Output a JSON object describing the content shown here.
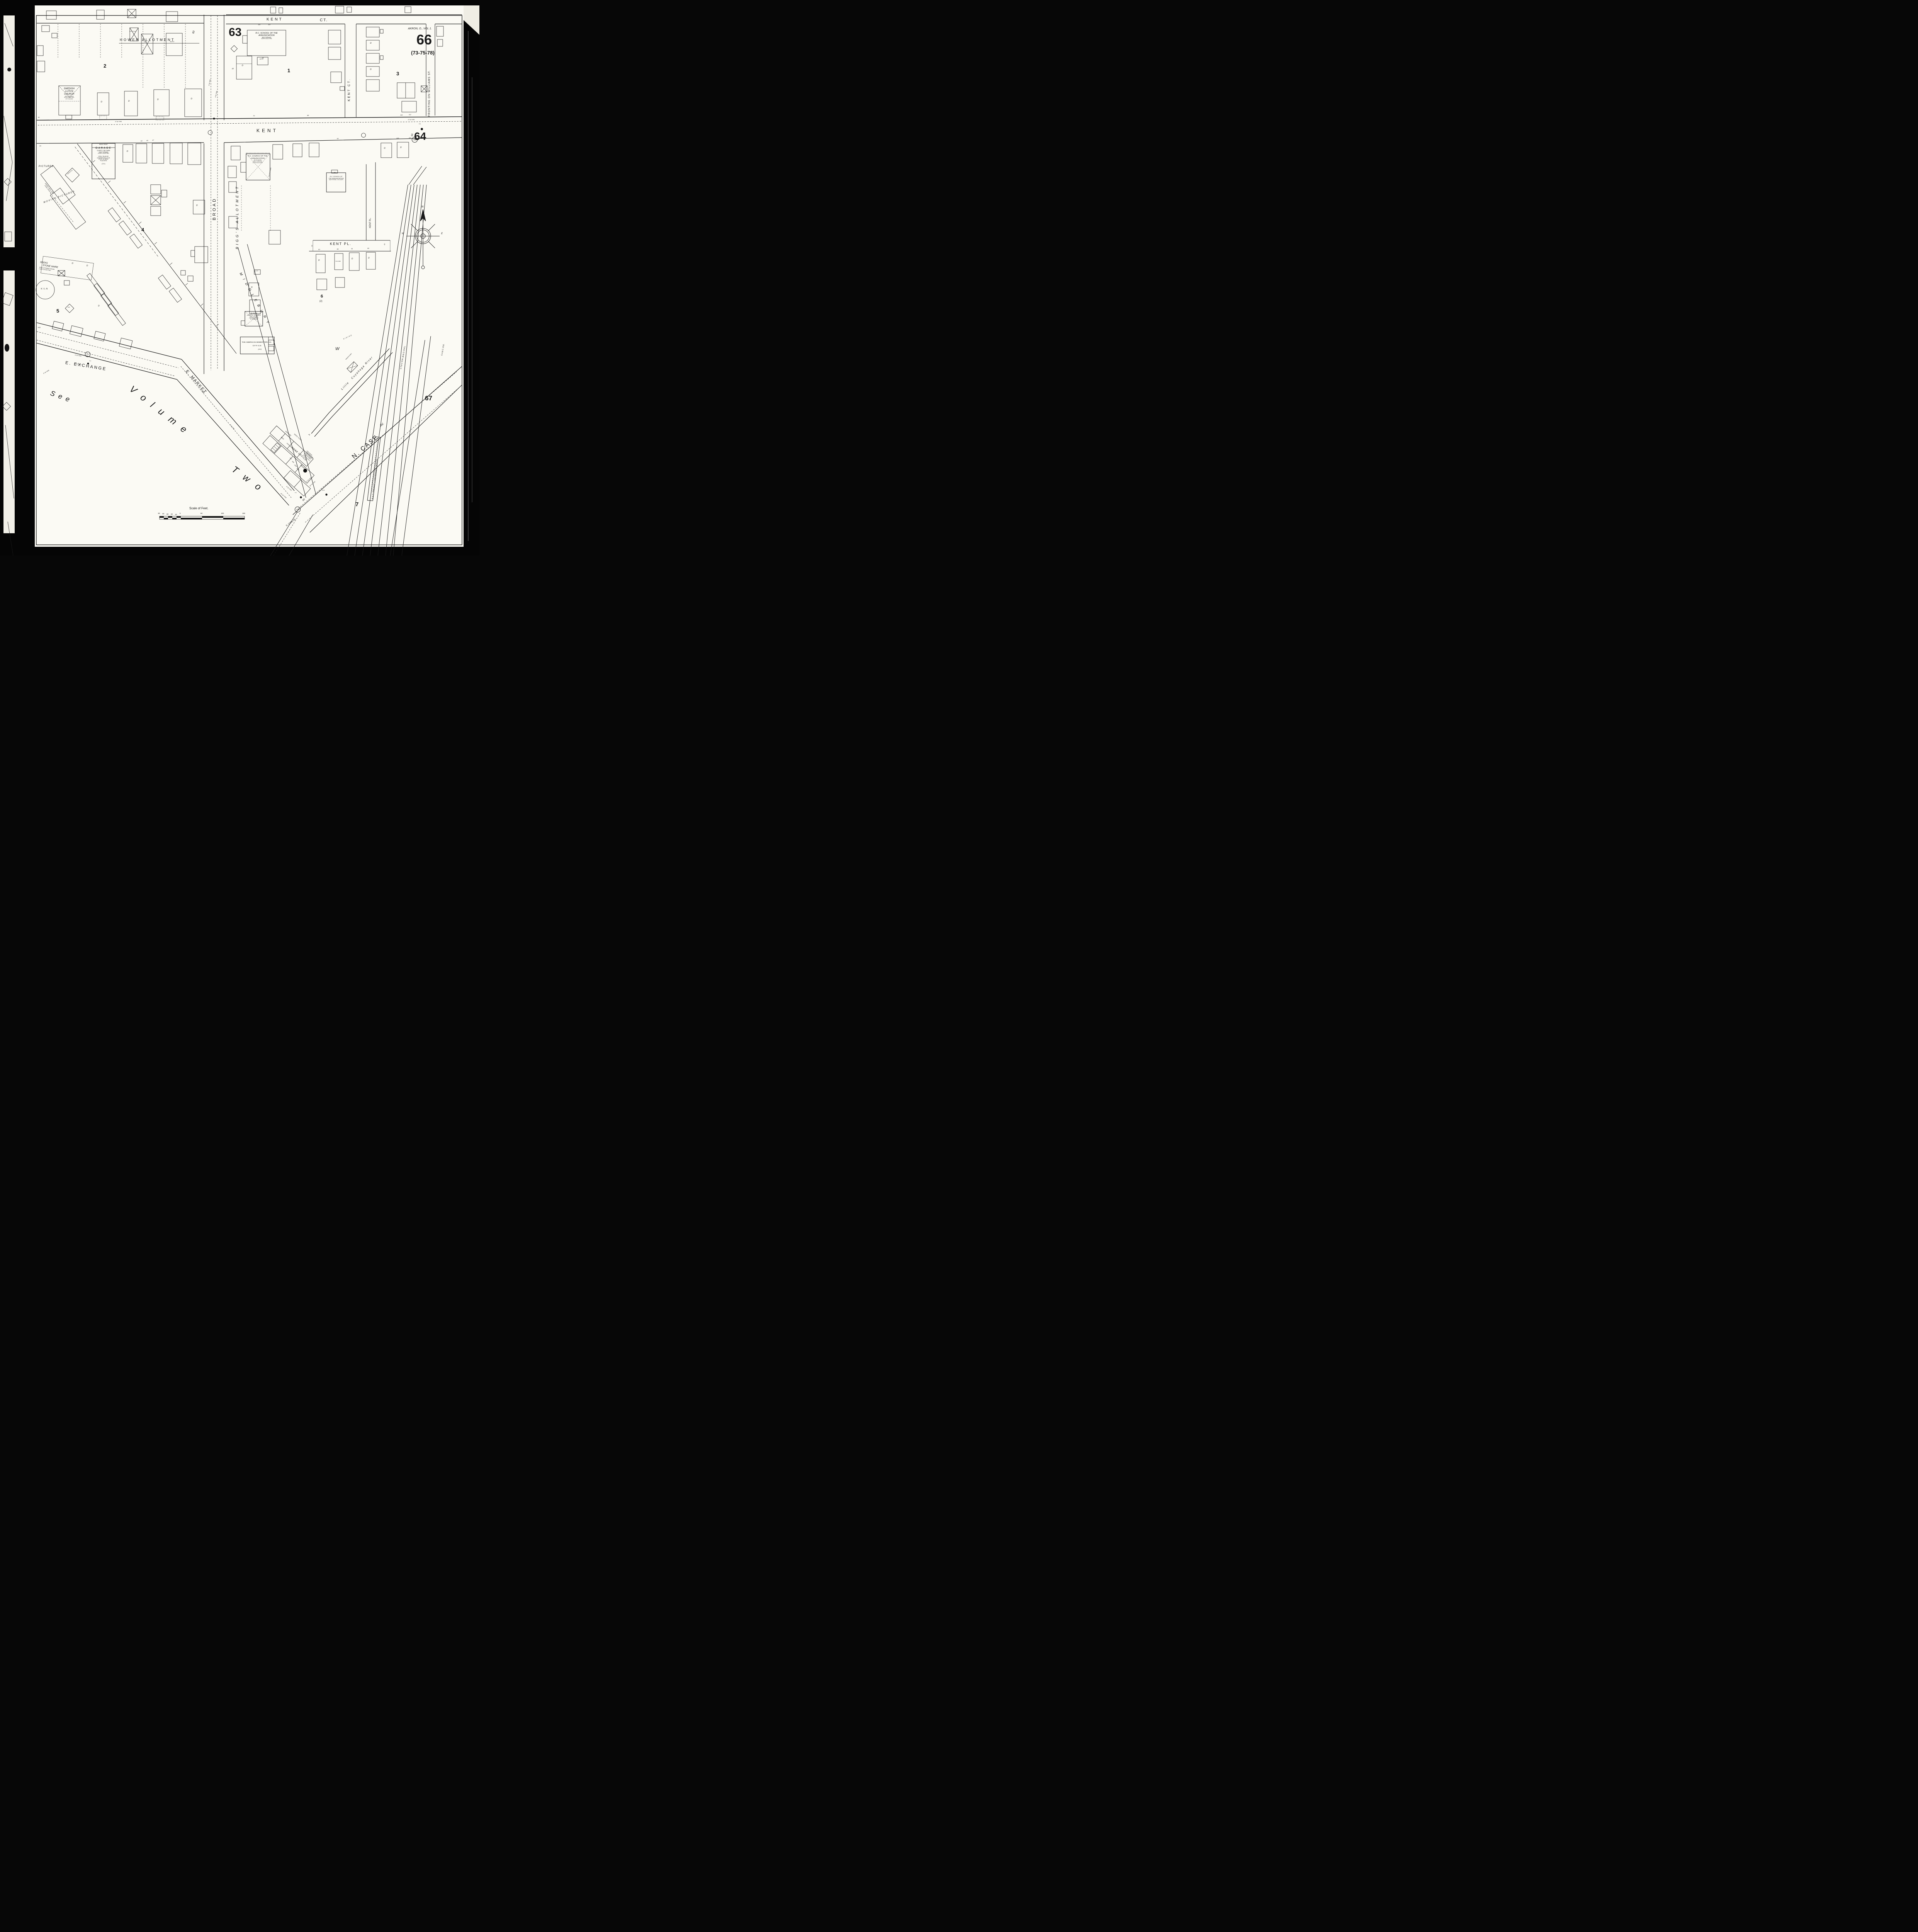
{
  "sheet_header": {
    "volume_label": "AKRON, O., VOL 1.",
    "sheet_number": "66",
    "cross_reference": "(73-75-78)"
  },
  "adjacent_sheets": {
    "top_left": "63",
    "right": "64",
    "bottom_right": "67"
  },
  "blocks": {
    "b1": "1",
    "b2": "2",
    "b3": "3",
    "b4": "4",
    "b5": "5",
    "b6": "6",
    "b6_sub": "(2)",
    "b7": "7",
    "hower": "HOWER ALLOTMENT",
    "biggs": "BIGG'S ALLOTMENT"
  },
  "streets": {
    "kent_ct_top_1": "KENT",
    "kent_ct_top_2": "CT.",
    "kent": "KENT",
    "kent_ct_vertical": "KENT CT.",
    "kent_pl": "KENT PL.",
    "kent_pl_vertical": "KENT PL.",
    "broad": "BROAD",
    "williams": "FRONTING ON WILLIAMS ST.",
    "e_exchange": "E. EXCHANGE",
    "e_market": "E. MARKET",
    "middlebury": "MIDDLEBURY",
    "middlebury_w": "W",
    "n_case": "N. CASE",
    "n_case_av": "AV.",
    "s_case": "S. CASE AV.",
    "see_volume_1": "See",
    "see_volume_2": "Volume",
    "see_volume_3": "Two",
    "width_60_broad": "60",
    "width_60_kent": "60",
    "width_60_market": "60",
    "width_60_case": "60"
  },
  "buildings": {
    "swedish_church": {
      "lines": [
        "SWEDISH",
        "LUTH'N",
        "CHURCH",
        "HEAT FURNACE",
        "LIGHTS ELECTRIC",
        "18' TO EAVES"
      ]
    },
    "rc_school_top": {
      "lines": [
        "R.C. SCHOOL OF THE",
        "ANNUNCIATION",
        "HEAT FURNACE",
        "LIGHTS ELECTRIC"
      ]
    },
    "annunciation_church": {
      "lines": [
        "R.C. CHURCH OF THE",
        "ANNUNCIATION",
        "28' TO EAVES",
        "HEAT FURNACE",
        "LIGHTS ELECTRIC"
      ],
      "side": "TILE PLASTERED"
    },
    "rc_school": {
      "lines": [
        "R.C. SCHOOL OF",
        "THE ANNUNCIATION",
        "HEAT STOVES - NO LIGHTS"
      ],
      "height": "25'"
    },
    "garage": {
      "lines": [
        "BRICK FRONT",
        "GARAGE",
        "CAPCY. 30 CARS",
        "HEAT: FURNACE",
        "LIGHTS: ELECTRIC",
        "STEEL TRUSS RF.",
        "CONCRETE RF. & FLR.",
        "8\"x16\"-16' BRICK",
        "PILASTERS",
        "(C.B.)"
      ]
    },
    "dance_hall": {
      "lines": [
        "DANCE HALL 2ND",
        "STEEL TRUSS RF."
      ]
    },
    "pictures": "PICTURES",
    "moving_pictures": "MOVING PICTURES",
    "auto_cb": "AUTO (C.B.)",
    "stone_ware": {
      "lines": [
        "SEEKS",
        "STONE WARE",
        "HEAT & POWER STEAM",
        "LIGHTS ELECTRIC"
      ]
    },
    "kiln": "KILN",
    "slavon_church": {
      "lines": [
        "SLAVON",
        "LUTH'N. CHURCH",
        "HEAT: FURNACE",
        "LIGHTS ELECTRIC",
        "16' TO EAVES"
      ]
    },
    "sewer_pipe_office": {
      "line1": "THE AMERICAN SEWER PIPE CO.",
      "line2": "OFFICE",
      "number": "(112)"
    },
    "post_office": "POST OFFICE",
    "drugs": "DRUGS",
    "fire_proof": {
      "lines": [
        "FIRE PROOF",
        "CONSTRUCTION",
        "STEEL FRAMED",
        "FLOORS CONC.",
        "CURTAIN WALLS"
      ]
    },
    "river_boarded": "RIVER BOARDED OVER",
    "seeds_flour": "SEEDS, FLOUR",
    "supplies": "SUPPLIES",
    "seed": "SEED",
    "wagon_shed": "WAGON SHED",
    "depot": "B.& O. FREIGHT & PASSENGER DEPOT",
    "auto_tile": "AUTO TILE",
    "tile": "TILE",
    "tile_lined": "TILE LINED",
    "auto": "AUTO",
    "dwelling": "D",
    "off": "OFF",
    "ho": "HO",
    "dh": "D.H."
  },
  "railroads": {
    "ctv": "C.T.& V. R.R. (B.& O. R.R.)",
    "cac": "C.A.& C. R.R.",
    "siding": "SIDING"
  },
  "river": {
    "word1": "Little",
    "word2": "Cuyahoga",
    "word3": "River"
  },
  "utilities": {
    "pipe_6": "6\" W. PIPE",
    "pipe_4": "4\" W. PIPE",
    "pipe_24": "24\" W. PIPE",
    "pipe_30": "30\" W. PIPE",
    "pipe_8": "8\" W. PIPE",
    "th": "T.H.",
    "manhole_188": "188",
    "manhole_227": "227",
    "manhole_205": "205"
  },
  "house_numbers": {
    "kent_north": [
      "30",
      "70",
      "88",
      "110",
      "112"
    ],
    "kent_south": [
      "25",
      "43",
      "45",
      "47",
      "93",
      "103",
      "107"
    ],
    "kent_pl": [
      "83",
      "85",
      "91",
      "95"
    ],
    "kent_pl_width": "25'",
    "market": [
      "997",
      "999",
      "1001",
      "1003"
    ],
    "block1_top": [
      "118",
      "119"
    ],
    "misc_26": "26",
    "misc_31": "31",
    "misc_32": "32"
  },
  "compass": {
    "n": "N",
    "e": "E",
    "w": "W"
  },
  "scale_bar": {
    "title": "Scale of Feet.",
    "ticks": [
      "50",
      "40",
      "30",
      "20",
      "10",
      "0",
      "50",
      "100",
      "150"
    ]
  }
}
